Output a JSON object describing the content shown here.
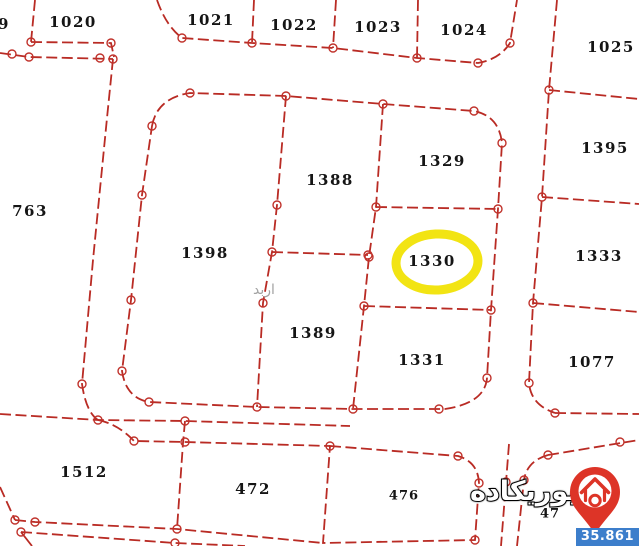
{
  "map": {
    "region_watermark": "اربد",
    "highlighted_parcel": "1330",
    "parcels": [
      {
        "label": "9"
      },
      {
        "label": "1020"
      },
      {
        "label": "1021"
      },
      {
        "label": "1022"
      },
      {
        "label": "1023"
      },
      {
        "label": "1024"
      },
      {
        "label": "1025"
      },
      {
        "label": "763"
      },
      {
        "label": "1388"
      },
      {
        "label": "1329"
      },
      {
        "label": "1395"
      },
      {
        "label": "1398"
      },
      {
        "label": "1330"
      },
      {
        "label": "1333"
      },
      {
        "label": "1389"
      },
      {
        "label": "1331"
      },
      {
        "label": "1077"
      },
      {
        "label": "1512"
      },
      {
        "label": "472"
      },
      {
        "label": "476"
      },
      {
        "label": "47"
      }
    ]
  },
  "logo": {
    "text": "يوريكاده"
  },
  "badge": {
    "value": "35.861"
  },
  "colors": {
    "boundary_line": "#b92b24",
    "highlight_ellipse": "#f2e413",
    "badge_bg": "#3c7ecb",
    "logo_red": "#dd3427",
    "label_text": "#151515",
    "watermark": "#a3a3a3"
  }
}
